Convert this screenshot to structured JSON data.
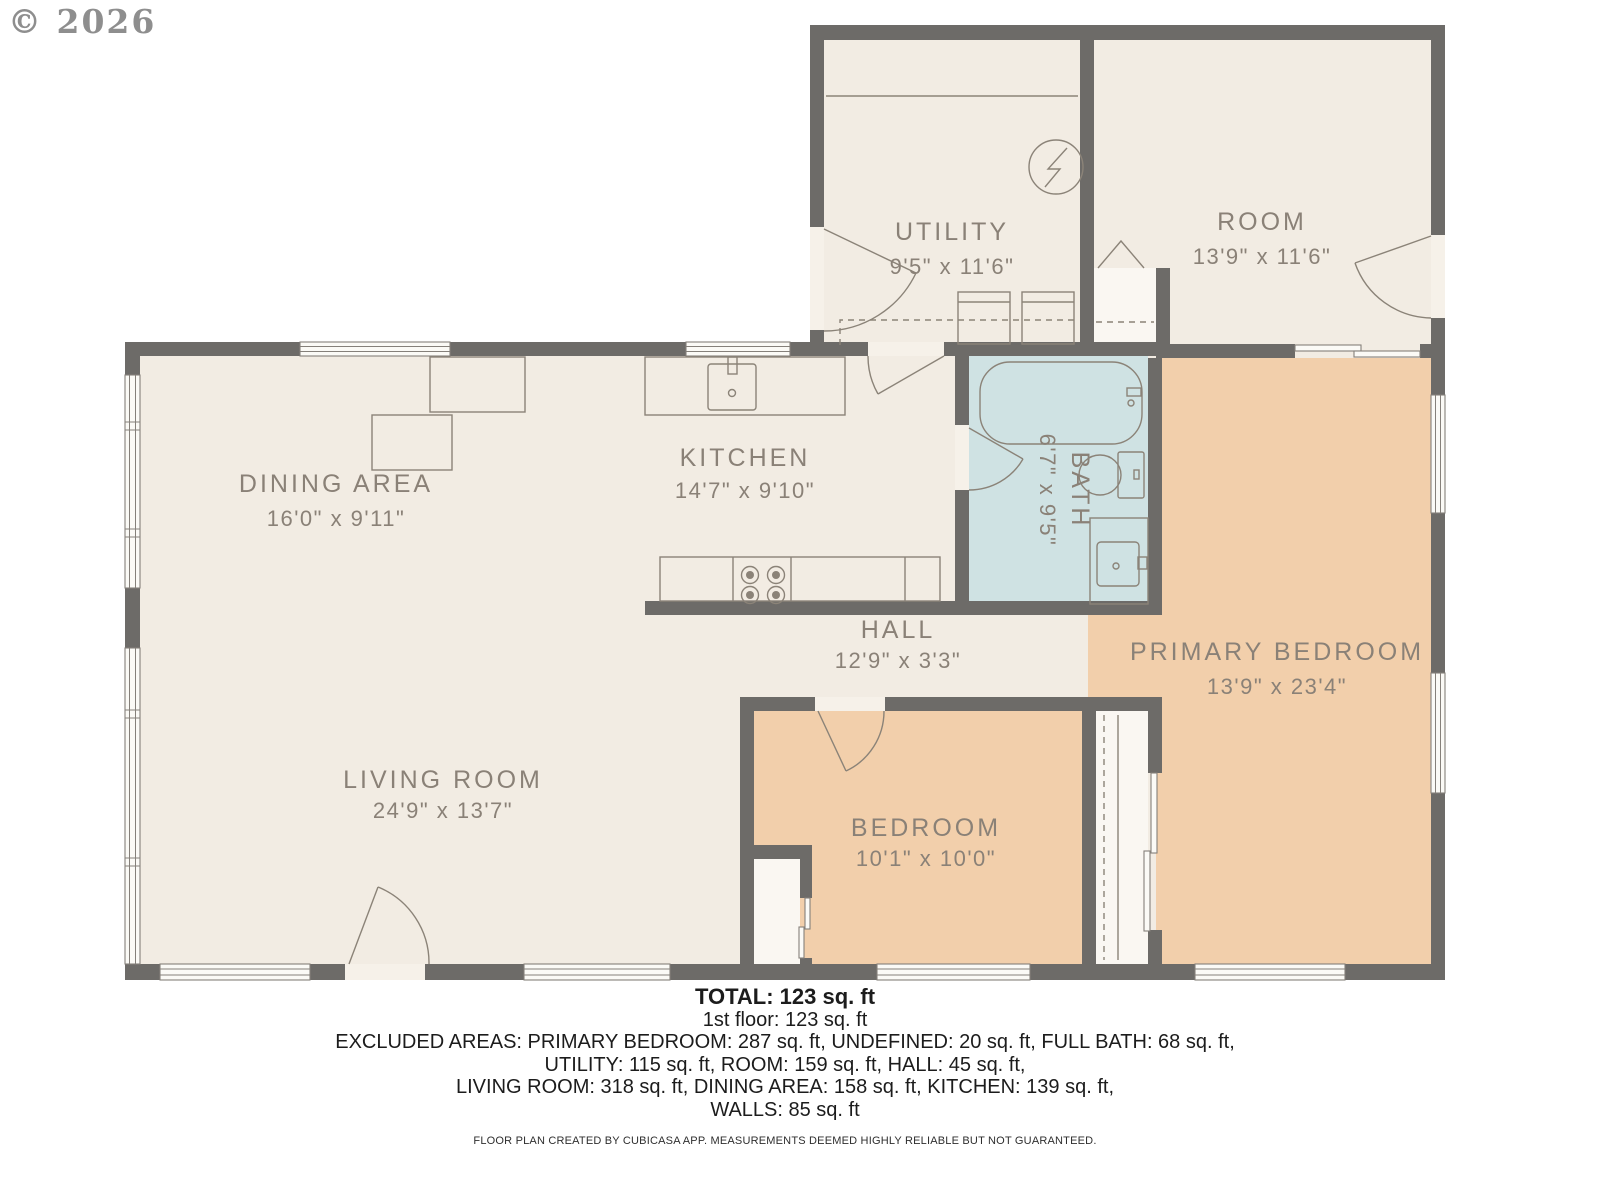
{
  "copyright": "© 2026",
  "colors": {
    "wall": "#6d6b68",
    "floor_cream": "#f2ece3",
    "floor_bath": "#cfe2e3",
    "floor_bedroom": "#f2cfab",
    "label_text": "#8a8177",
    "footer_text": "#1c1c1c"
  },
  "rooms": [
    {
      "name": "UTILITY",
      "dims": "9'5\" x 11'6\""
    },
    {
      "name": "ROOM",
      "dims": "13'9\" x 11'6\""
    },
    {
      "name": "DINING AREA",
      "dims": "16'0\" x 9'11\""
    },
    {
      "name": "KITCHEN",
      "dims": "14'7\" x 9'10\""
    },
    {
      "name": "BATH",
      "dims": "6'7\" x 9'5\""
    },
    {
      "name": "HALL",
      "dims": "12'9\" x 3'3\""
    },
    {
      "name": "LIVING ROOM",
      "dims": "24'9\" x 13'7\""
    },
    {
      "name": "BEDROOM",
      "dims": "10'1\" x 10'0\""
    },
    {
      "name": "PRIMARY BEDROOM",
      "dims": "13'9\" x 23'4\""
    }
  ],
  "summary": {
    "total": "TOTAL: 123 sq. ft",
    "floor1": "1st floor: 123 sq. ft",
    "excluded1": "EXCLUDED AREAS: PRIMARY BEDROOM: 287 sq. ft, UNDEFINED: 20 sq. ft, FULL BATH: 68 sq. ft,",
    "excluded2": "UTILITY: 115 sq. ft, ROOM: 159 sq. ft, HALL: 45 sq. ft,",
    "excluded3": "LIVING ROOM: 318 sq. ft, DINING AREA: 158 sq. ft, KITCHEN: 139 sq. ft,",
    "excluded4": "WALLS: 85 sq. ft"
  },
  "disclaimer": "FLOOR PLAN CREATED BY CUBICASA APP. MEASUREMENTS DEEMED HIGHLY RELIABLE BUT NOT GUARANTEED."
}
